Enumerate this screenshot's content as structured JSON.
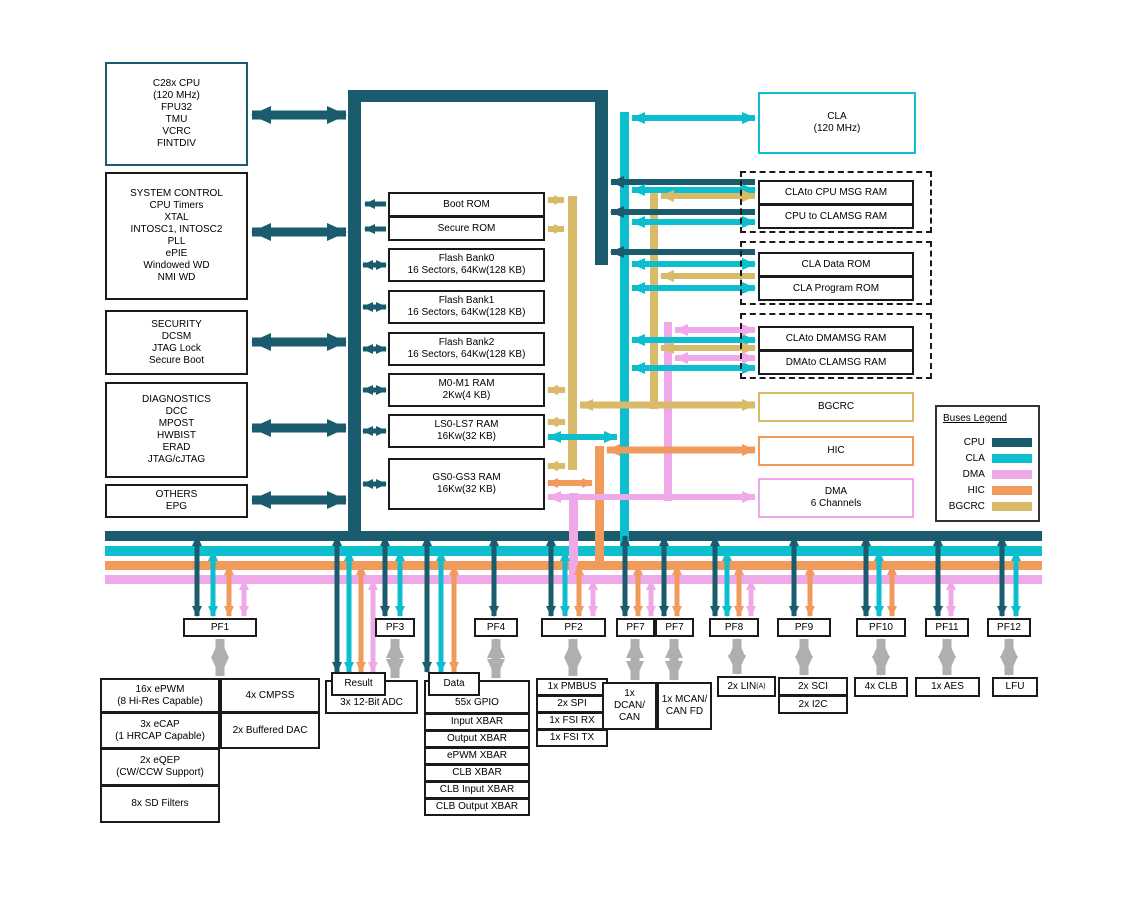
{
  "colors": {
    "cpu": "#1A5B6E",
    "cla": "#0DBECE",
    "dma": "#F0A9E8",
    "hic": "#F09A5B",
    "bgcrc": "#D8BA69",
    "gray": "#AFAFAF"
  },
  "left_blocks": {
    "cpu": [
      "C28x CPU",
      "(120 MHz)",
      "FPU32",
      "TMU",
      "VCRC",
      "FINTDIV"
    ],
    "system_control": [
      "SYSTEM CONTROL",
      "CPU Timers",
      "XTAL",
      "INTOSC1, INTOSC2",
      "PLL",
      "ePIE",
      "Windowed WD",
      "NMI WD"
    ],
    "security": [
      "SECURITY",
      "DCSM",
      "JTAG Lock",
      "Secure Boot"
    ],
    "diagnostics": [
      "DIAGNOSTICS",
      "DCC",
      "MPOST",
      "HWBIST",
      "ERAD",
      "JTAG/cJTAG"
    ],
    "others": [
      "OTHERS",
      "EPG"
    ]
  },
  "memory_blocks": {
    "boot_rom": "Boot ROM",
    "secure_rom": "Secure ROM",
    "flash_bank0": [
      "Flash Bank0",
      "16 Sectors, 64Kw(128 KB)"
    ],
    "flash_bank1": [
      "Flash Bank1",
      "16 Sectors, 64Kw(128 KB)"
    ],
    "flash_bank2": [
      "Flash Bank2",
      "16 Sectors, 64Kw(128 KB)"
    ],
    "m0_m1_ram": [
      "M0-M1 RAM",
      "2Kw(4 KB)"
    ],
    "ls0_ls7_ram": [
      "LS0-LS7 RAM",
      "16Kw(32 KB)"
    ],
    "gs0_gs3_ram": [
      "GS0-GS3 RAM",
      "16Kw(32 KB)"
    ]
  },
  "right_blocks": {
    "cla": [
      "CLA",
      "(120 MHz)"
    ],
    "cla_to_cpu_msg_ram": "CLAto CPU MSG RAM",
    "cpu_to_cla_msg_ram": "CPU to CLAMSG RAM",
    "cla_data_rom": "CLA Data ROM",
    "cla_program_rom": "CLA Program ROM",
    "cla_to_dma_msg_ram": "CLAto DMAMSG RAM",
    "dma_to_cla_msg_ram": "DMAto CLAMSG RAM",
    "bgcrc": "BGCRC",
    "hic": "HIC",
    "dma": [
      "DMA",
      "6 Channels"
    ]
  },
  "legend": {
    "title": "Buses Legend",
    "entries": [
      {
        "label": "CPU",
        "color": "#1A5B6E"
      },
      {
        "label": "CLA",
        "color": "#0DBECE"
      },
      {
        "label": "DMA",
        "color": "#F0A9E8"
      },
      {
        "label": "HIC",
        "color": "#F09A5B"
      },
      {
        "label": "BGCRC",
        "color": "#D8BA69"
      }
    ]
  },
  "peripheral_frames": {
    "pf1": "PF1",
    "pf3": "PF3",
    "pf4": "PF4",
    "pf2": "PF2",
    "pf7a": "PF7",
    "pf7b": "PF7",
    "pf8": "PF8",
    "pf9": "PF9",
    "pf10": "PF10",
    "pf11": "PF11",
    "pf12": "PF12"
  },
  "peripherals": {
    "epwm": [
      "16x ePWM",
      "(8 Hi-Res Capable)"
    ],
    "cmpss": "4x CMPSS",
    "ecap": [
      "3x eCAP",
      "(1 HRCAP Capable)"
    ],
    "buffered_dac": "2x Buffered DAC",
    "eqep": [
      "2x eQEP",
      "(CW/CCW Support)"
    ],
    "sd_filters": "8x SD Filters",
    "adc": "3x 12-Bit ADC",
    "adc_result": "Result",
    "gpio": "55x GPIO",
    "gpio_data": "Data",
    "xbars": [
      "Input XBAR",
      "Output XBAR",
      "ePWM XBAR",
      "CLB XBAR",
      "CLB Input XBAR",
      "CLB Output XBAR"
    ],
    "pmbus": "1x PMBUS",
    "spi": "2x SPI",
    "fsi_rx": "1x FSI RX",
    "fsi_tx": "1x FSI TX",
    "dcan": [
      "1x",
      "DCAN/",
      "CAN"
    ],
    "mcan": [
      "1x MCAN/",
      "CAN FD"
    ],
    "lin": "2x LIN",
    "lin_sup": "(A)",
    "sci": "2x SCI",
    "i2c": "2x I2C",
    "clb": "4x CLB",
    "aes": "1x AES",
    "lfu": "LFU"
  }
}
